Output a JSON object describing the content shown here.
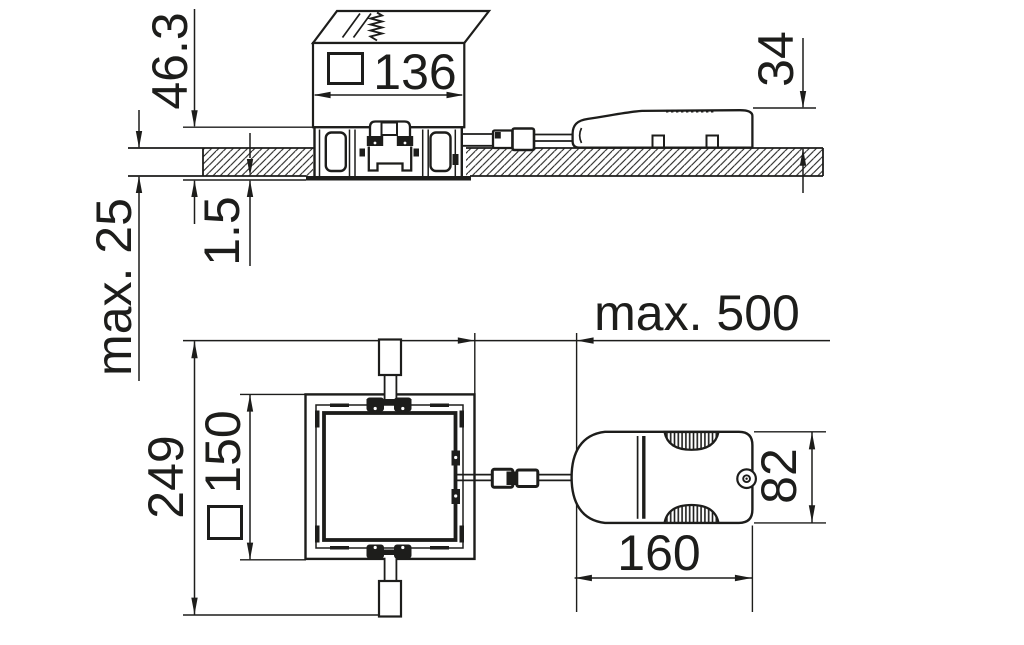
{
  "title": "Recessed luminaire installation dimension drawing",
  "colors": {
    "ink": "#1d1d1b",
    "paper": "#ffffff"
  },
  "section_view": {
    "name": "side section view (ceiling cross-section)",
    "dims": {
      "recess_depth": "46.3",
      "housing_width": "136",
      "driver_height": "34",
      "ceiling_thickness": "max. 25",
      "trim_protrusion": "1.5"
    },
    "symbols": {
      "square_section": "square-outline-symbol"
    }
  },
  "plan_view": {
    "name": "rear plan view",
    "dims": {
      "overall_length": "249",
      "cutout_square": "150",
      "cable_length": "max. 500",
      "driver_length": "160",
      "driver_width": "82"
    },
    "symbols": {
      "square_section": "square-outline-symbol"
    }
  }
}
